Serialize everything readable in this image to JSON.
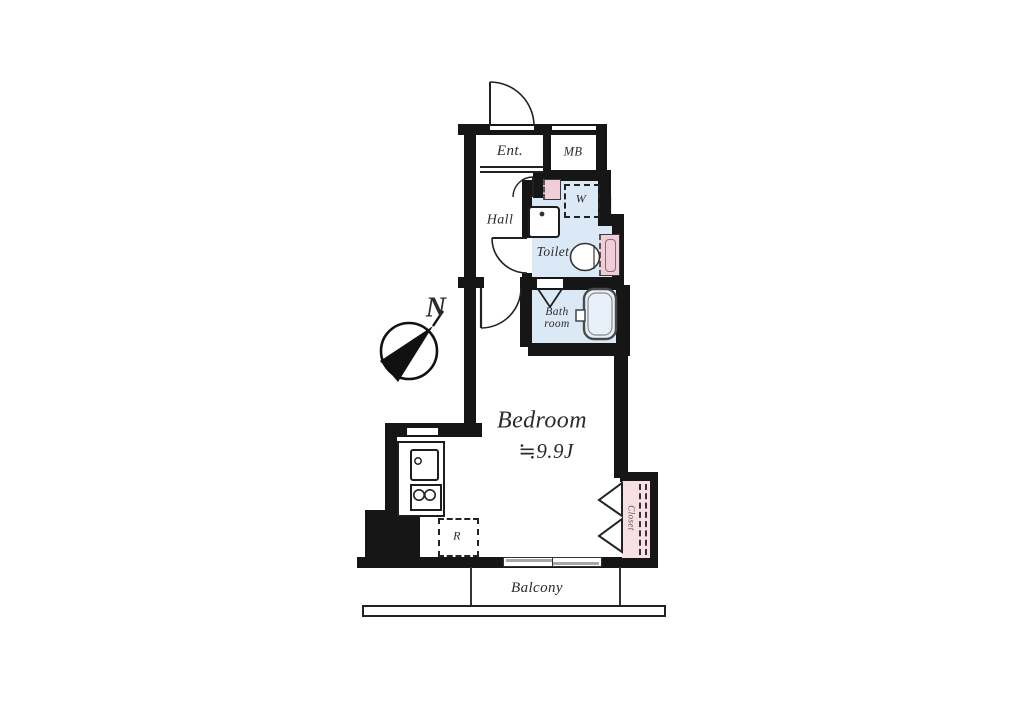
{
  "plan": {
    "rooms": {
      "entrance": "Ent.",
      "meter_box": "MB",
      "hall": "Hall",
      "toilet": "Toilet",
      "bath_line1": "Bath",
      "bath_line2": "room",
      "bedroom": "Bedroom",
      "bedroom_area": "≒9.9J",
      "balcony": "Balcony"
    },
    "fixtures": {
      "washer_space": "W",
      "refrigerator_space": "R",
      "closet": "Closet"
    },
    "compass": {
      "north": "N"
    },
    "colors": {
      "wall": "#161616",
      "wet_area": "#dbe9f6",
      "closet_pink": "#f7dfe5",
      "fixture_pink": "#f0cdd7",
      "window_gray": "#a8a8ab"
    }
  }
}
